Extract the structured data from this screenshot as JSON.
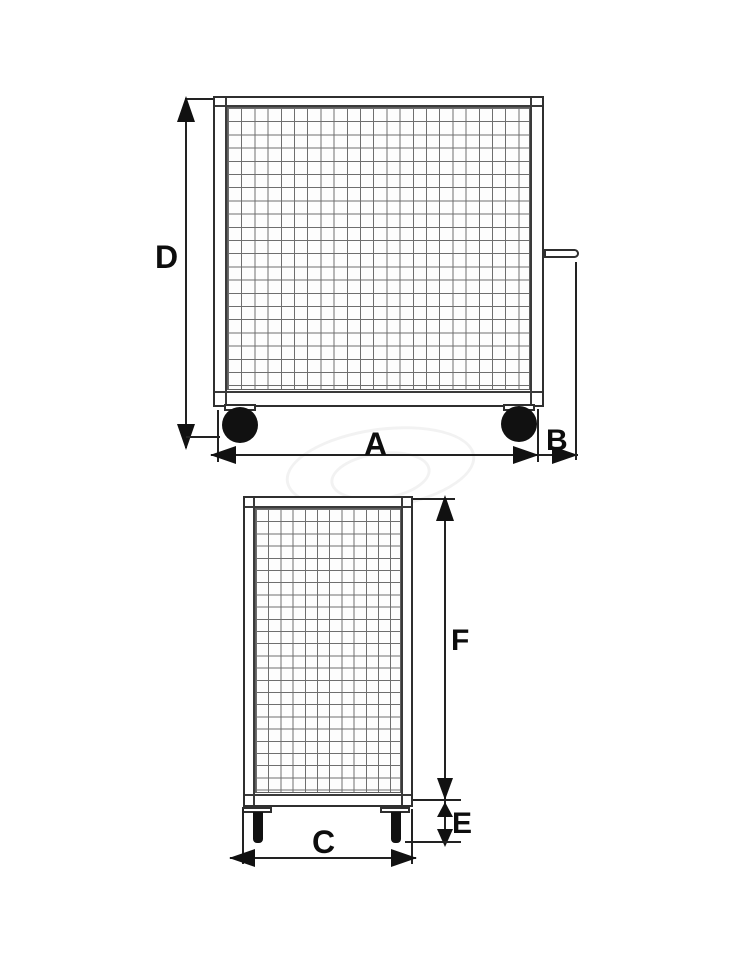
{
  "labels": {
    "a": "A",
    "b": "B",
    "c": "C",
    "d": "D",
    "e": "E",
    "f": "F"
  },
  "colors": {
    "frame_line": "#2f2f2f",
    "dimension_line": "#222222",
    "mesh_grid": "#6e6e6e",
    "solid_fill": "#111111",
    "background": "#ffffff"
  }
}
